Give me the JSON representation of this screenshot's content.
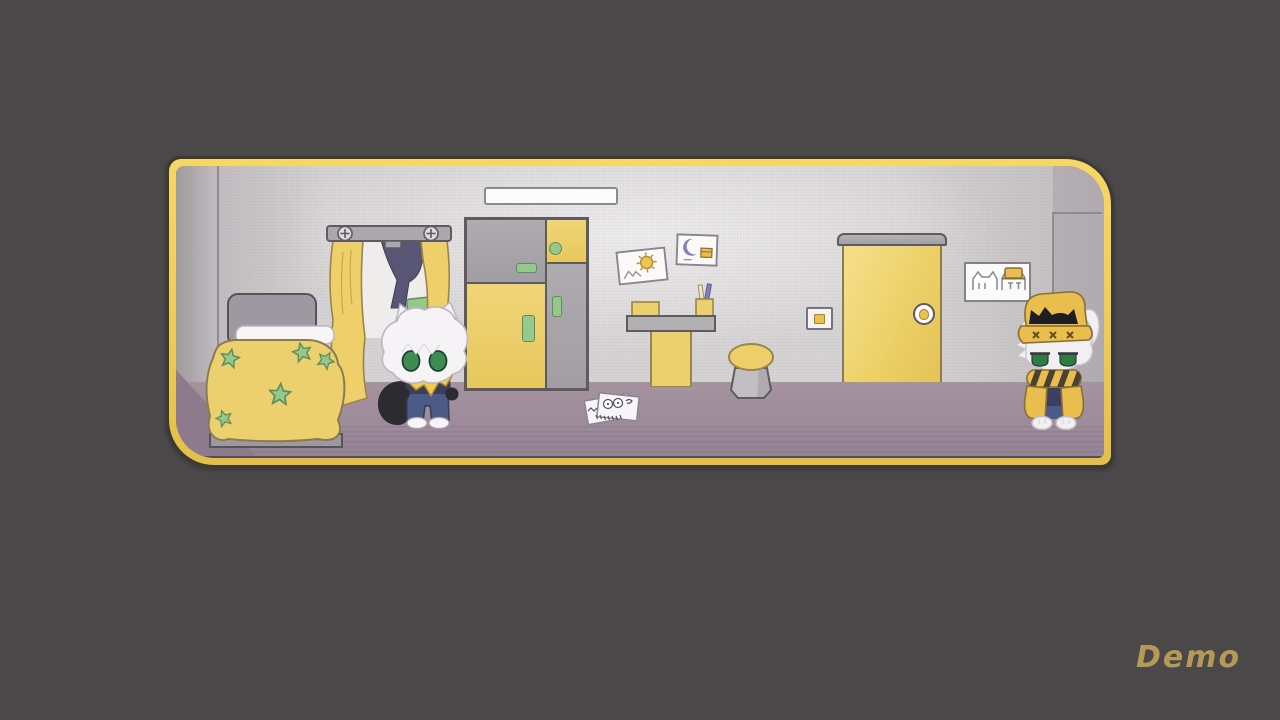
{
  "hud": {
    "demo_label": "Demo"
  },
  "palette": {
    "background": "#4a4848",
    "frame_gold": "#f2cf5c",
    "frame_outline": "#3d3935",
    "wall": "#d6d3d4",
    "wall_side": "#a4a0a4",
    "floor": "#a2909e",
    "floor_shadow": "#8d7b8d",
    "accent_yellow": "#ecd068",
    "accent_green": "#97c88b",
    "furniture_gray": "#9c9aa0",
    "navy": "#3b4062",
    "denim_blue": "#4b5a87",
    "eye_green": "#3f8c53",
    "fur_white": "#f5f3f5",
    "demo_text": "#b49a55"
  },
  "scene": {
    "description": "Pastel bedroom scene inside a gold rounded game frame on a dark gray desktop",
    "objects": [
      {
        "id": "ceiling-light",
        "label": "ceiling light bar"
      },
      {
        "id": "bed",
        "label": "bed with yellow star blanket"
      },
      {
        "id": "window",
        "label": "window with yellow curtains and hanging clothes"
      },
      {
        "id": "wardrobe",
        "label": "gray and yellow wardrobe with green handles"
      },
      {
        "id": "poster-sun",
        "label": "sun doodle poster"
      },
      {
        "id": "poster-moon",
        "label": "moon doodle poster"
      },
      {
        "id": "desk",
        "label": "desk with box and pencil cup"
      },
      {
        "id": "stool",
        "label": "round stool"
      },
      {
        "id": "floor-papers",
        "label": "doodled papers on the floor"
      },
      {
        "id": "light-switch",
        "label": "light switch"
      },
      {
        "id": "door",
        "label": "yellow door with round handle"
      },
      {
        "id": "cat-picture",
        "label": "framed cat drawings, one wearing a yellow hat"
      }
    ],
    "characters": [
      {
        "id": "character-left",
        "label": "white-haired cat kid with green eyes, yellow neckerchief, blue pants and black tail"
      },
      {
        "id": "character-right",
        "label": "white-haired cat kid with yellow bucket hat, striped scarf and yellow jacket"
      }
    ]
  }
}
